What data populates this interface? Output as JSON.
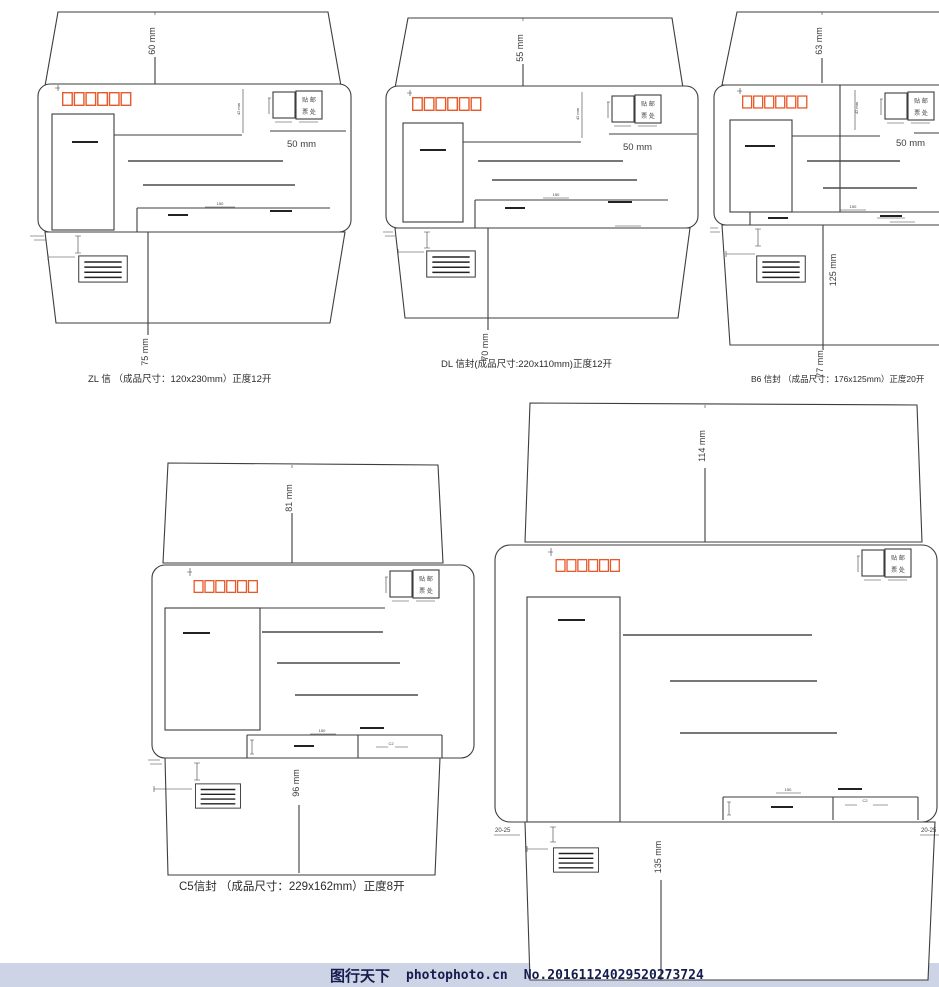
{
  "page": {
    "width": 939,
    "height": 987,
    "background": "#ffffff"
  },
  "colors": {
    "line": "#3d3d3d",
    "postal_box": "#e8592a",
    "watermark_bar": "#ccd4e6",
    "watermark_text": "#151c4e"
  },
  "stamp_label": {
    "line1": "贴 邮",
    "line2": "票 处"
  },
  "envelopes": [
    {
      "name": "ZL",
      "caption": "ZL 信 （成品尺寸：120x230mm）正度12开",
      "dims": {
        "top_flap": "60 mm",
        "stamp_height": "42 mm",
        "stamp_width": "50 mm",
        "strip": "150",
        "bottom_flap": "75 mm"
      }
    },
    {
      "name": "DL",
      "caption": "DL 信封(成品尺寸:220x110mm)正度12开",
      "dims": {
        "top_flap": "55 mm",
        "stamp_height": "42 mm",
        "stamp_width": "50 mm",
        "strip": "150",
        "bottom_flap": "70 mm"
      }
    },
    {
      "name": "B6",
      "caption": "B6 信封 （成品尺寸：176x125mm）正度20开",
      "dims": {
        "top_flap": "63 mm",
        "stamp_height": "42 mm",
        "stamp_width": "50 mm",
        "strip": "150",
        "inner_flap": "125 mm",
        "bottom_flap": "77 mm"
      }
    },
    {
      "name": "C5",
      "caption": "C5信封 （成品尺寸：229x162mm）正度8开",
      "dims": {
        "top_flap": "81 mm",
        "strip": "150",
        "strip2": "C2",
        "bottom_flap": "96 mm"
      }
    },
    {
      "name": "C4",
      "dims": {
        "top_flap": "114 mm",
        "strip": "150",
        "strip2": "C2",
        "glue_left": "20-25",
        "glue_right": "20-25",
        "bottom_flap": "135 mm"
      }
    }
  ],
  "watermark": {
    "brand": "图行天下",
    "site": "photophoto.cn",
    "serial": "No.20161124029520273724"
  }
}
